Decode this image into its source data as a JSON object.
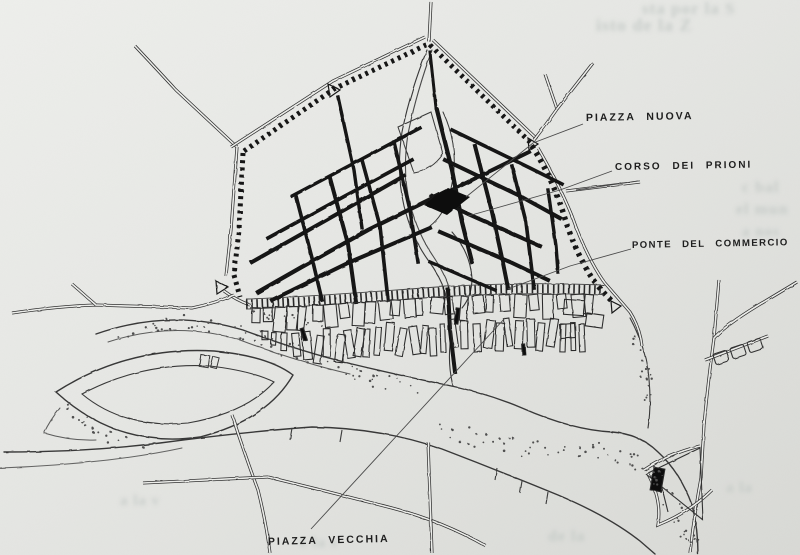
{
  "figure": {
    "kind": "scanned city plan (book figure)",
    "labels": [
      {
        "id": "piazza-nuova",
        "text": "PIAZZA NUOVA"
      },
      {
        "id": "corso-dei-prioni",
        "text": "CORSO DEI PRIONI"
      },
      {
        "id": "ponte-del-commercio",
        "text": "PONTE DEL COMMERCIO"
      },
      {
        "id": "piazza-vecchia",
        "text": "PIAZZA VECCHIA"
      }
    ],
    "bleedthrough_fragments": [
      {
        "text": "sta por la S",
        "x": 642,
        "y": 14,
        "size": 17
      },
      {
        "text": "isto de la Z",
        "x": 596,
        "y": 31,
        "size": 18
      },
      {
        "text": "c bal",
        "x": 742,
        "y": 192,
        "size": 16
      },
      {
        "text": "el mun",
        "x": 736,
        "y": 214,
        "size": 16
      },
      {
        "text": "a nos",
        "x": 742,
        "y": 236,
        "size": 15
      },
      {
        "text": "a la v",
        "x": 120,
        "y": 505,
        "size": 15
      },
      {
        "text": "e la s",
        "x": 300,
        "y": 547,
        "size": 15
      },
      {
        "text": "de la",
        "x": 548,
        "y": 541,
        "size": 16
      },
      {
        "text": "a la",
        "x": 726,
        "y": 492,
        "size": 15
      }
    ],
    "colors": {
      "paper_light": "#ecedea",
      "paper_dark": "#dcddd9",
      "ink": "#161616",
      "line": "#3a3a3a",
      "thin": "#4a4a4a",
      "ghost": "#c2c8c5",
      "stipple": "#4f4f4f"
    }
  }
}
